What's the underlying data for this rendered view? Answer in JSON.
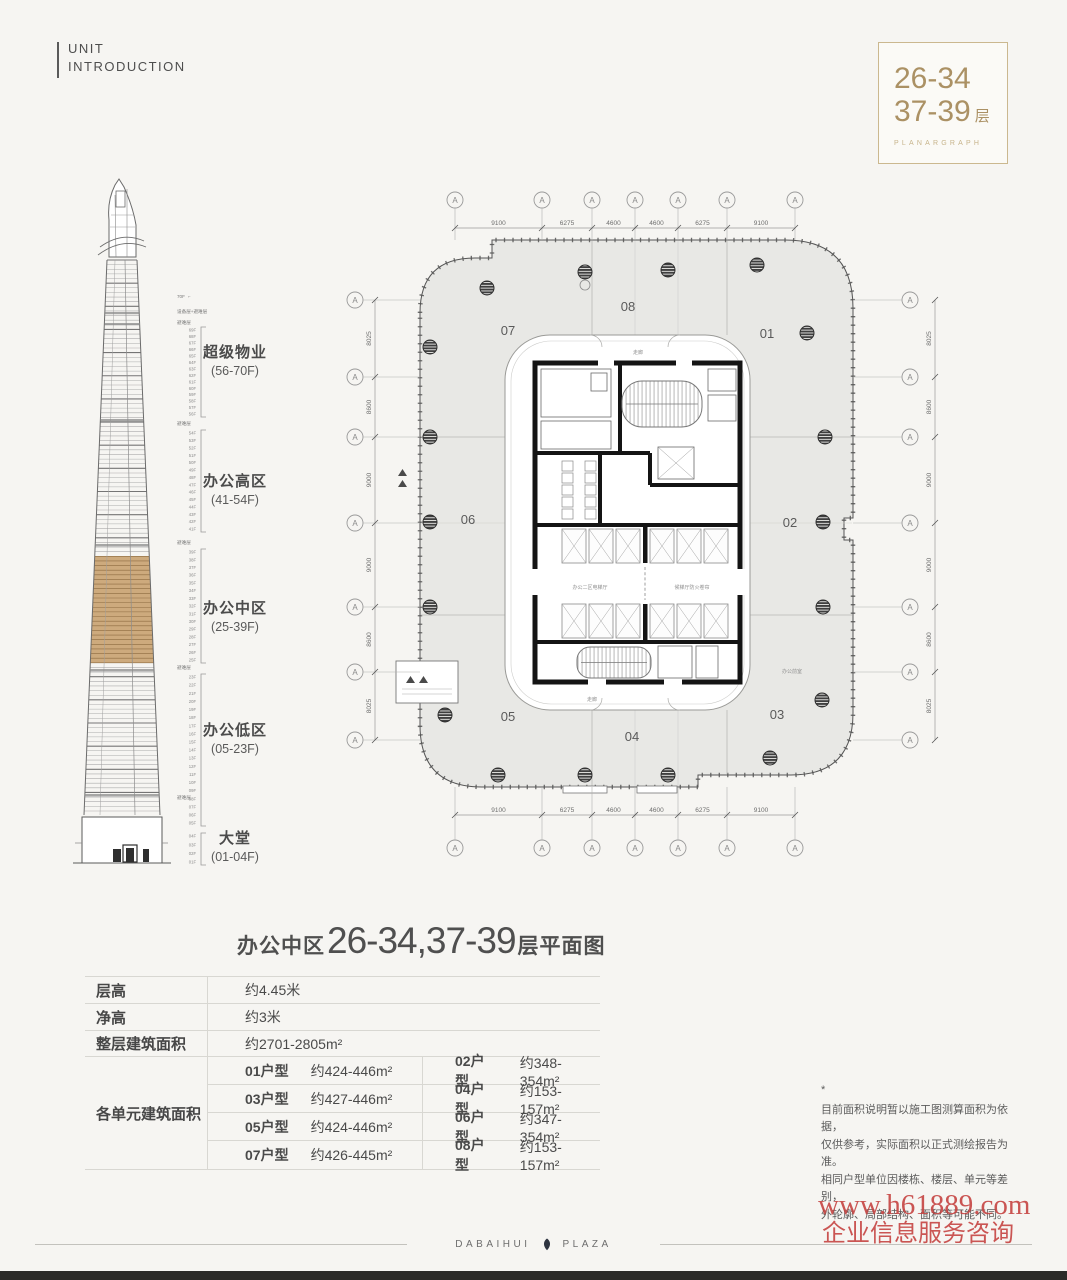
{
  "page": {
    "background": "#f6f5f2"
  },
  "header": {
    "kicker": [
      "UNIT",
      "INTRODUCTION"
    ]
  },
  "floor_badge": {
    "line1": "26-34",
    "line2": "37-39",
    "floor_suffix": "层",
    "subtitle": "PLANARGRAPH",
    "accent_color": "#ab9164"
  },
  "tower": {
    "roof_label": "70F",
    "equipment_label": "设备层+避难层",
    "refuge_label": "避难层",
    "highlight_color": "#cdaa7d",
    "zones": [
      {
        "name": "超级物业",
        "range": "(56-70F)",
        "top_floor": 69,
        "bottom_floor": 56
      },
      {
        "name": "办公高区",
        "range": "(41-54F)",
        "top_floor": 54,
        "bottom_floor": 41
      },
      {
        "name": "办公中区",
        "range": "(25-39F)",
        "top_floor": 39,
        "bottom_floor": 25,
        "highlighted": true
      },
      {
        "name": "办公低区",
        "range": "(05-23F)",
        "top_floor": 23,
        "bottom_floor": 5
      },
      {
        "name": "大堂",
        "range": "(01-04F)",
        "top_floor": 4,
        "bottom_floor": 1
      }
    ]
  },
  "plan": {
    "axis_letter": "A",
    "top_dims": [
      "9100",
      "6275",
      "4600",
      "4600",
      "6275",
      "9100"
    ],
    "bottom_dims": [
      "9100",
      "6275",
      "4600",
      "4600",
      "6275",
      "9100"
    ],
    "left_dims": [
      "8025",
      "8600",
      "9000",
      "9000",
      "8600",
      "8025"
    ],
    "right_dims": [
      "8025",
      "8600",
      "9000",
      "9000",
      "8600",
      "8025"
    ],
    "unit_labels": [
      "07",
      "08",
      "01",
      "06",
      "02",
      "05",
      "04",
      "03"
    ],
    "core_labels": {
      "corridor_left": "办公二区电梯厅",
      "corridor_right": "候梯厅防火卷帘",
      "vestibule": "办公前室",
      "walkway_top": "走廊",
      "walkway_bottom": "走廊"
    }
  },
  "plan_title": {
    "prefix": "办公中区",
    "numbers": "26-34,37-39",
    "suffix": "层平面图"
  },
  "spec_table": {
    "rows": [
      {
        "label": "层高",
        "value": "约4.45米"
      },
      {
        "label": "净高",
        "value": "约3米"
      },
      {
        "label": "整层建筑面积",
        "value": "约2701-2805m²"
      }
    ],
    "units_label": "各单元建筑面积",
    "unit_rows": [
      [
        {
          "no": "01户型",
          "area": "约424-446m²"
        },
        {
          "no": "02户型",
          "area": "约348-354m²"
        }
      ],
      [
        {
          "no": "03户型",
          "area": "约427-446m²"
        },
        {
          "no": "04户型",
          "area": "约153-157m²"
        }
      ],
      [
        {
          "no": "05户型",
          "area": "约424-446m²"
        },
        {
          "no": "06户型",
          "area": "约347-354m²"
        }
      ],
      [
        {
          "no": "07户型",
          "area": "约426-445m²"
        },
        {
          "no": "08户型",
          "area": "约153-157m²"
        }
      ]
    ]
  },
  "notes": {
    "mark": "*",
    "lines": [
      "目前面积说明暂以施工图测算面积为依据，",
      "仅供参考，实际面积以正式测绘报告为准。",
      "相同户型单位因楼栋、楼层、单元等差别，",
      "外轮廓、局部结构、面积等可能不同。"
    ]
  },
  "watermark": {
    "line1": "www.h61889.com",
    "line2": "企业信息服务咨询",
    "color": "#c5403e"
  },
  "footer": {
    "brand": "DABAIHUI",
    "brand2": "PLAZA"
  }
}
